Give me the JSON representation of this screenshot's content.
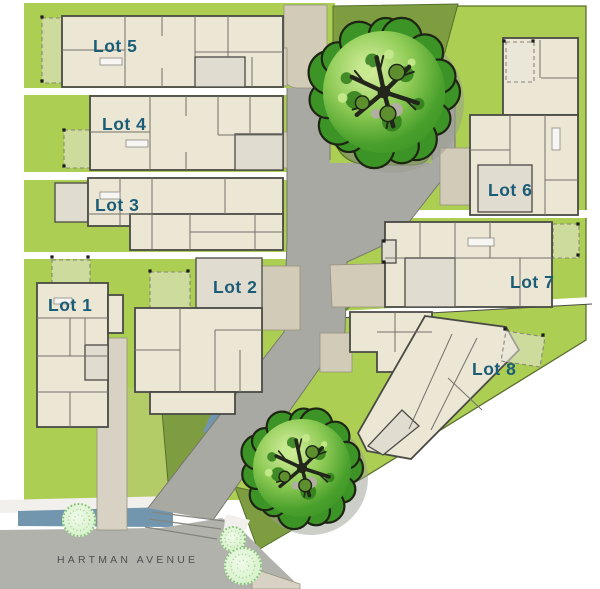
{
  "page": {
    "type": "residential development site plan"
  },
  "street": {
    "label": "HARTMAN AVENUE"
  },
  "lots": [
    {
      "label": "Lot 1"
    },
    {
      "label": "Lot 2"
    },
    {
      "label": "Lot 3"
    },
    {
      "label": "Lot 4"
    },
    {
      "label": "Lot 5"
    },
    {
      "label": "Lot 6"
    },
    {
      "label": "Lot 7"
    },
    {
      "label": "Lot 8"
    }
  ],
  "landscape": {
    "large_trees": 2,
    "shrubs": 3
  },
  "colors": {
    "lot_label": "#1b5c77",
    "street_label": "#4e4f51",
    "grass_bright": "#abce53",
    "grass_olive": "#7e9c40",
    "grass_moss": "#b3cc68",
    "road": "#a9a9a4",
    "street_road": "#b2b2ad",
    "sidewalk": "#f1f0ec",
    "driveway": "#d2cbb8",
    "house_fill": "#ece6d4",
    "house_wall": "#4a4a45",
    "garage_fill": "#e1dcd0",
    "water": "#7296ae",
    "tree_canopy": "#3c9426",
    "tree_outline": "#1e2413",
    "shrub": "#d9f1cf"
  }
}
